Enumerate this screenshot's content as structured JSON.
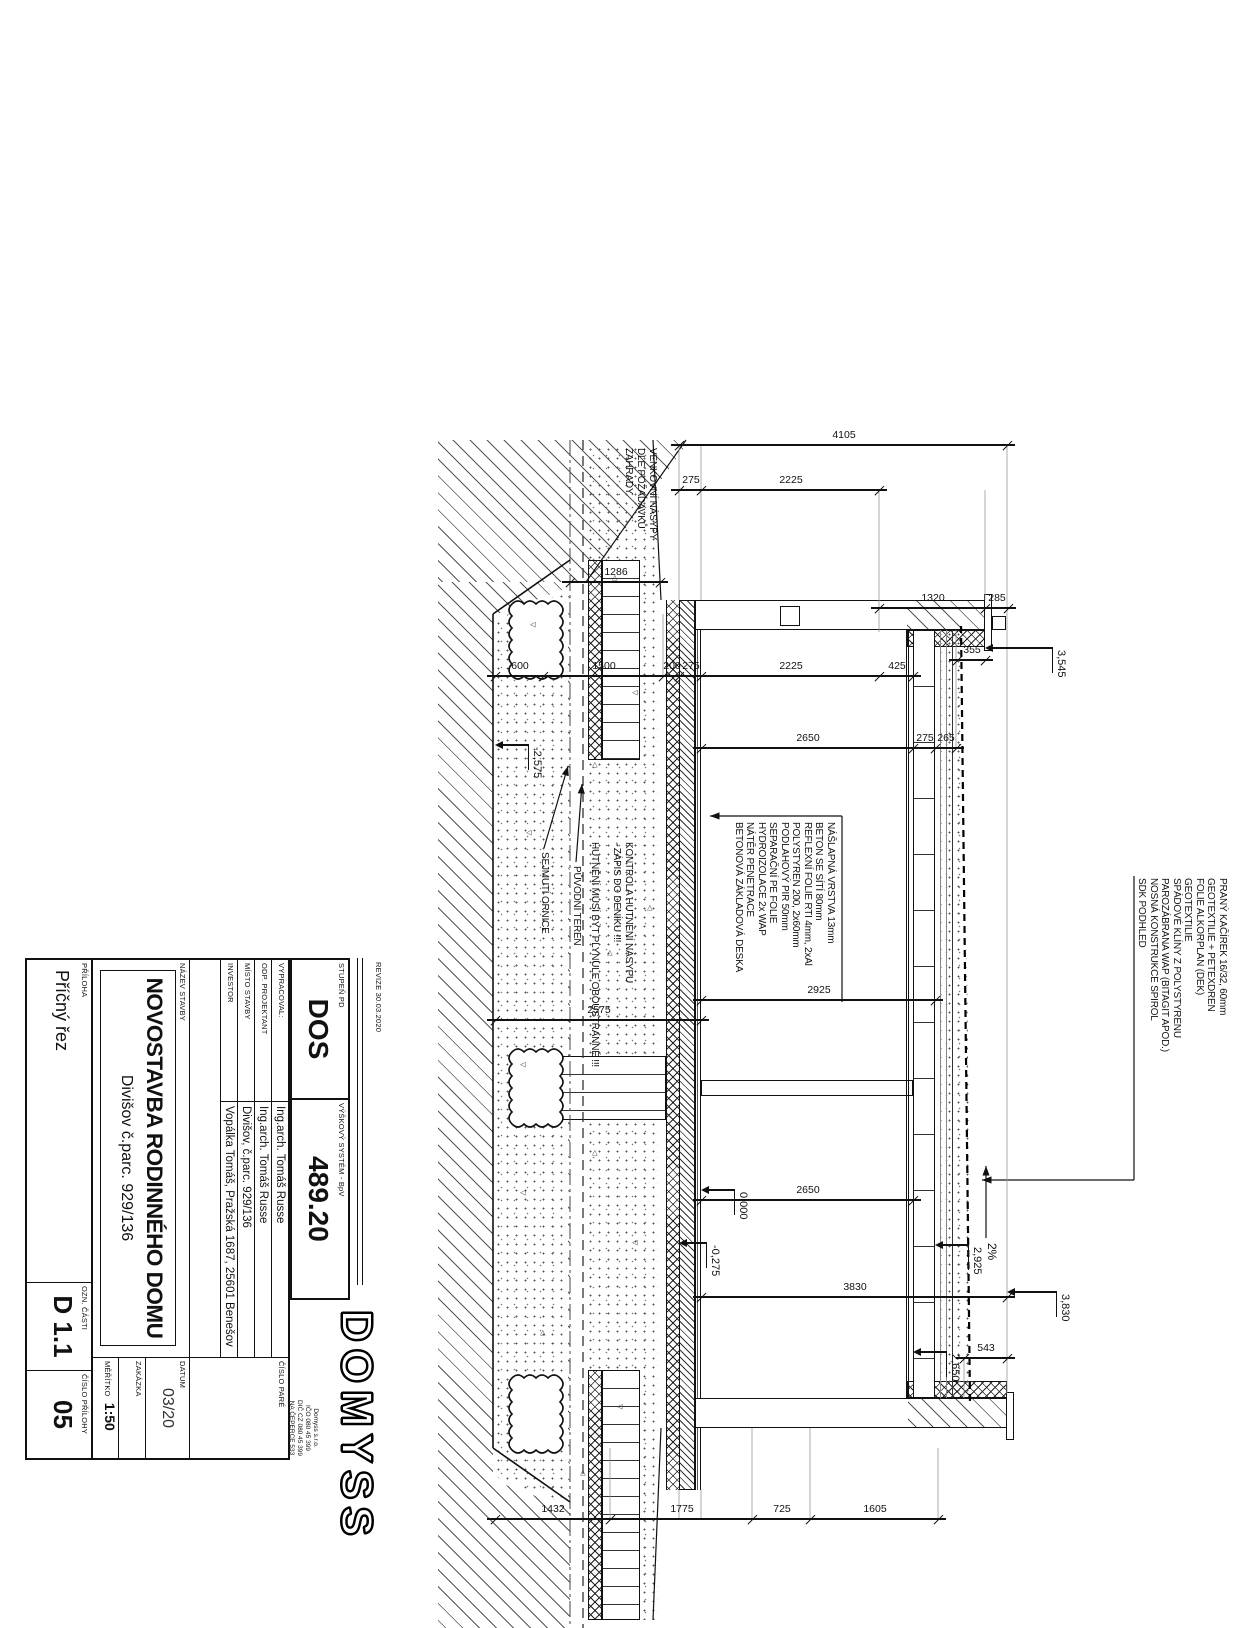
{
  "titleblock": {
    "revize": "REVIZE 30.03.2020",
    "logo": "DOMYSS",
    "company_lines": [
      "Domyss s.r.o.",
      "IČO 080 45 399",
      "DIČ CZ 080 45 399",
      "NA ČEPERCE 533",
      "25751 BYSTŘICE"
    ],
    "stupen_label": "STUPEŇ PD",
    "stupen_value": "DOS",
    "vyskovy_label": "VÝŠKOVÝ SYSTÉM - BpV",
    "vyskovy_value": "489.20",
    "rows": [
      {
        "label": "VYPRACOVAL:",
        "value": "Ing.arch. Tomáš Russe"
      },
      {
        "label": "ODP. PROJEKTANT",
        "value": "Ing.arch. Tomáš Russe"
      },
      {
        "label": "MÍSTO STAVBY",
        "value": "Divišov, č.parc. 929/136"
      },
      {
        "label": "INVESTOR",
        "value": "Vopálka Tomáš, Pražská 1687, 25601 Benešov"
      }
    ],
    "cislo_pare_label": "ČÍSLO PARÉ",
    "nazev_label": "NÁZEV STAVBY",
    "nazev_value1": "NOVOSTAVBA RODINNÉHO DOMU",
    "nazev_value2": "Divišov č.parc. 929/136",
    "datum_label": "DATUM",
    "datum_value": "03/20",
    "zakazka_label": "ZAKÁZKA",
    "meritko_label": "MĚŘÍTKO",
    "meritko_value": "1:50",
    "priloha_label": "PŘÍLOHA",
    "priloha_value": "Příčný řez",
    "ozn_label": "OZN. ČÁSTI",
    "ozn_value": "D 1.1",
    "cislo_prilohy_label": "ČÍSLO PŘÍLOHY",
    "cislo_prilohy_value": "05"
  },
  "drawing": {
    "roof_layers": [
      "PRANÝ KAČÍREK 16/32, 60mm",
      "GEOTEXTILIE + PETEXDREN",
      "FOLIE ALKORPLAN (DEK)",
      "GEOTEXTILIE",
      "SPÁDOVÉ KLÍNY Z POLYSTYRENU",
      "PAROZÁBRANA WAP (BITAGIT APOD.)",
      "NOSNÁ KONSTRUKCE SPIROL",
      "SDK PODHLED"
    ],
    "floor_layers": [
      "NÁŠLAPNÁ VRSTVA 13mm",
      "BETON SE SÍTÍ 80mm",
      "REFLEXNÍ FOLIE RTI 4mm, 2xAl",
      "POLYSTYREN 200, 2x60mm",
      "PODLAHOVÝ PIR 50mm",
      "SEPARAČNÍ PE FOLIE",
      "HYDROIZOLACE 2x WAP",
      "NÁTĚR PENETRACE",
      "BETONOVÁ ZÁKLADOVÁ DESKA"
    ],
    "notes": {
      "venkovni": [
        "VENKOVNÍ NÁSYPY",
        "DLE POŽADAVKŮ",
        "ZAHRADY"
      ],
      "kontrola": [
        "KONTROLA HUTNĚNÍ NÁSYPU",
        "- ZÁPIS DO DENÍKU !!!"
      ],
      "hutneni": [
        "HUTNĚNÍ MUSÍ BÝT PLYNULE OBOUSTRANNÉ !!!"
      ],
      "sejmuti": "SEJMUTÍ ORNICE",
      "puvodni": "PŮVODNÍ TERÉN"
    },
    "slope_label": "2%",
    "dim_chains": [
      {
        "x": 445,
        "segs": [
          {
            "v": "4105",
            "y1": 231,
            "y2": 559
          }
        ]
      },
      {
        "x": 490,
        "segs": [
          {
            "v": "2225",
            "y1": 359,
            "y2": 537
          },
          {
            "v": "275",
            "y1": 537,
            "y2": 559
          }
        ]
      },
      {
        "x": 608,
        "segs": [
          {
            "v": "285",
            "y1": 230,
            "y2": 253
          },
          {
            "v": "1320",
            "y1": 253,
            "y2": 359
          }
        ]
      },
      {
        "x": 660,
        "segs": [
          {
            "v": "355",
            "y1": 253,
            "y2": 281
          }
        ]
      },
      {
        "x": 676,
        "segs": [
          {
            "v": "425",
            "y1": 325,
            "y2": 359
          },
          {
            "v": "2225",
            "y1": 359,
            "y2": 537
          },
          {
            "v": "275",
            "y1": 537,
            "y2": 559
          },
          {
            "v": "200",
            "y1": 559,
            "y2": 575
          },
          {
            "v": "1500",
            "y1": 575,
            "y2": 695
          },
          {
            "v": "600",
            "y1": 695,
            "y2": 743
          }
        ]
      },
      {
        "x": 748,
        "segs": [
          {
            "v": "265",
            "y1": 282,
            "y2": 303
          },
          {
            "v": "275",
            "y1": 303,
            "y2": 325
          },
          {
            "v": "2650",
            "y1": 325,
            "y2": 537
          }
        ]
      },
      {
        "x": 582,
        "segs": [
          {
            "v": "1286",
            "y1": 578,
            "y2": 668
          }
        ]
      },
      {
        "x": 1020,
        "segs": [
          {
            "v": "2575",
            "y1": 537,
            "y2": 743
          }
        ]
      },
      {
        "x": 1000,
        "segs": [
          {
            "v": "2925",
            "y1": 303,
            "y2": 537
          }
        ]
      },
      {
        "x": 1200,
        "segs": [
          {
            "v": "2650",
            "y1": 325,
            "y2": 537
          }
        ]
      },
      {
        "x": 1297,
        "segs": [
          {
            "v": "3830",
            "y1": 231,
            "y2": 537
          }
        ]
      },
      {
        "x": 1358,
        "segs": [
          {
            "v": "543",
            "y1": 231,
            "y2": 274
          }
        ]
      },
      {
        "x": 1519,
        "segs": [
          {
            "v": "1605",
            "y1": 300,
            "y2": 428
          },
          {
            "v": "725",
            "y1": 428,
            "y2": 486
          },
          {
            "v": "1775",
            "y1": 486,
            "y2": 628
          },
          {
            "v": "1432",
            "y1": 628,
            "y2": 743
          }
        ]
      }
    ],
    "levels": [
      {
        "v": "0,000",
        "ax": 1190,
        "ay": 537,
        "stem": 26
      },
      {
        "v": "-0,275",
        "ax": 1243,
        "ay": 559,
        "stem": 20
      },
      {
        "v": "2,925",
        "ax": 1245,
        "ay": 303,
        "stem": 26
      },
      {
        "v": "2,650",
        "ax": 1352,
        "ay": 325,
        "stem": 26
      },
      {
        "v": "3,545",
        "ax": 648,
        "ay": 253,
        "stem": 60
      },
      {
        "v": "3,830",
        "ax": 1292,
        "ay": 231,
        "stem": 42
      },
      {
        "v": "-2,575",
        "ax": 745,
        "ay": 743,
        "stem": 26
      }
    ]
  }
}
